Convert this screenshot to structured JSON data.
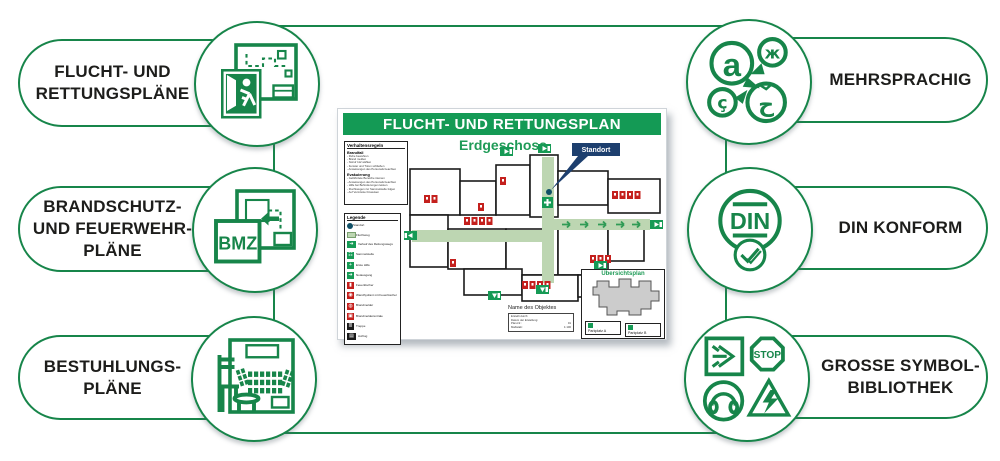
{
  "colors": {
    "brand_green": "#17854a",
    "plan_header_green": "#149a55",
    "route_green": "#bdd6b2",
    "sign_green": "#169a55",
    "standort_navy": "#1d3f6e",
    "symbol_red": "#c4201d",
    "text": "#1d1d1b"
  },
  "features": {
    "left": [
      {
        "id": "flucht-rettungsplaene",
        "icon": "escape-plan",
        "lines": [
          "FLUCHT- UND",
          "RETTUNGSPLÄNE"
        ]
      },
      {
        "id": "brandschutz-feuerwehrplaene",
        "icon": "fire-protection-plan",
        "lines": [
          "BRANDSCHUTZ-",
          "UND FEUERWEHR-",
          "PLÄNE"
        ],
        "icon_text": "BMZ"
      },
      {
        "id": "bestuhlungsplaene",
        "icon": "seating-plan",
        "lines": [
          "BESTUHLUNGS-",
          "PLÄNE"
        ]
      }
    ],
    "right": [
      {
        "id": "mehrsprachig",
        "icon": "multilingual",
        "lines": [
          "MEHRSPRACHIG"
        ],
        "glyphs": [
          "a",
          "ж",
          "ç",
          "ح"
        ]
      },
      {
        "id": "din-konform",
        "icon": "din-conform",
        "lines": [
          "DIN KONFORM"
        ],
        "icon_text": "DIN"
      },
      {
        "id": "grosse-symbolbibliothek",
        "icon": "symbol-library",
        "lines": [
          "GROSSE SYMBOL-",
          "BIBLIOTHEK"
        ],
        "icon_text": "STOP"
      }
    ]
  },
  "plan": {
    "title": "FLUCHT- UND RETTUNGSPLAN",
    "floor": "Erdgeschoss",
    "standort": "Standort",
    "rules": {
      "title": "Verhaltensregeln",
      "sections": [
        {
          "heading": "Brandfall",
          "items": [
            "Ruhe bewahren",
            "Brand melden",
            "Notruf 112 wählen",
            "Fenster und Türen schließen",
            "Anweisungen des Personals beachten"
          ]
        },
        {
          "heading": "Evakuierung",
          "items": [
            "Gefährdete Bereiche räumen",
            "Anweisungen des Personals beachten",
            "Hilfe bei Behinderungen leisten",
            "Fluchtwegen zur Sammelstelle folgen",
            "Auf Vermisste hinweisen"
          ]
        }
      ]
    },
    "legend": {
      "title": "Legende",
      "items": [
        {
          "label": "Standort",
          "type": "dot"
        },
        {
          "label": "Fluchtweg",
          "type": "route"
        },
        {
          "label": "Verlauf des Rettungswegs",
          "type": "route-sign"
        },
        {
          "label": "Sammelstelle",
          "type": "assembly"
        },
        {
          "label": "Erste Hilfe",
          "type": "first-aid"
        },
        {
          "label": "Notausgang",
          "type": "exit"
        },
        {
          "label": "Feuerlöscher",
          "type": "extinguisher"
        },
        {
          "label": "Wandhydrant mit Feuerlöscher",
          "type": "hydrant"
        },
        {
          "label": "Brandmelder",
          "type": "alarm"
        },
        {
          "label": "Brandmeldezentrale",
          "type": "alarm-center"
        },
        {
          "label": "Treppe",
          "type": "stairs"
        },
        {
          "label": "Aufzug",
          "type": "elevator"
        }
      ]
    },
    "overview": {
      "title": "Übersichtsplan",
      "spots": [
        "Parkplatz A",
        "Parkplatz B"
      ]
    },
    "titleblock": {
      "object_name": "Name des Objektes",
      "rows": [
        [
          "Erstellt durch:",
          ""
        ],
        [
          "Datum der Erstellung:",
          ""
        ],
        [
          "Plan-Nr.:",
          "01"
        ],
        [
          "Maßstab:",
          "1:100"
        ]
      ]
    }
  }
}
